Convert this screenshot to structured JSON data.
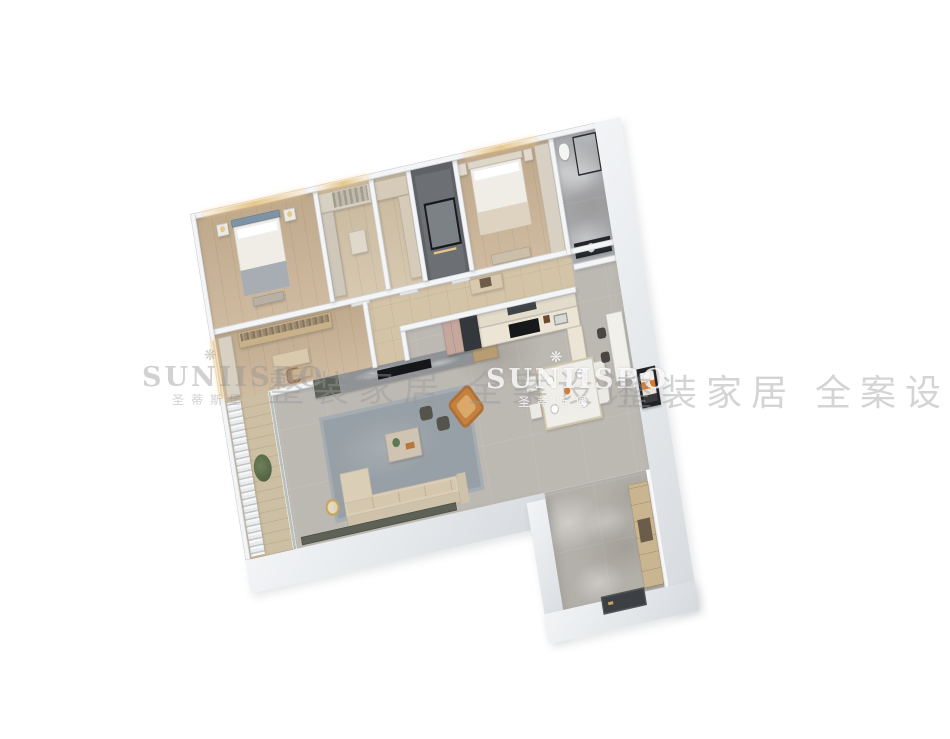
{
  "watermark": {
    "brand": "SUNIISBO",
    "brand_cn": "圣蒂斯堡",
    "flower_icon": "❋",
    "tagline": "整装家居 全案设计"
  },
  "palette": {
    "bg": "#ffffff",
    "wall": "#f4f5f7",
    "outer_light": "#f2f4f6",
    "outer_dark": "#d6dade",
    "marble": "#bcb8b2",
    "marble_leg": "#b3afa9",
    "wood": "#c9b294",
    "plank": "#cdbfa3",
    "tile": "#d3c3a7",
    "rug": "#97a0a6",
    "dark_room": "#5f6367",
    "tv_marble": "#909396",
    "tv_screen": "#141619",
    "cabinet_green": "#5c6157",
    "sofa": "#dbceb7",
    "armchair": "#c5813f",
    "kitchen_cab": "#ece5d6",
    "fridge": "#c5a79e",
    "appliance": "#34373b",
    "gold": "#e6c88a",
    "bed_blue": "#7e93a6",
    "bedding": "#f0ede6",
    "wardrobe": "#d8d1c3",
    "entry_cab": "#c9b58f",
    "door_dark": "#3c3f43",
    "art_orange": "#d97b2e",
    "watermark": "#9a9a9a"
  }
}
